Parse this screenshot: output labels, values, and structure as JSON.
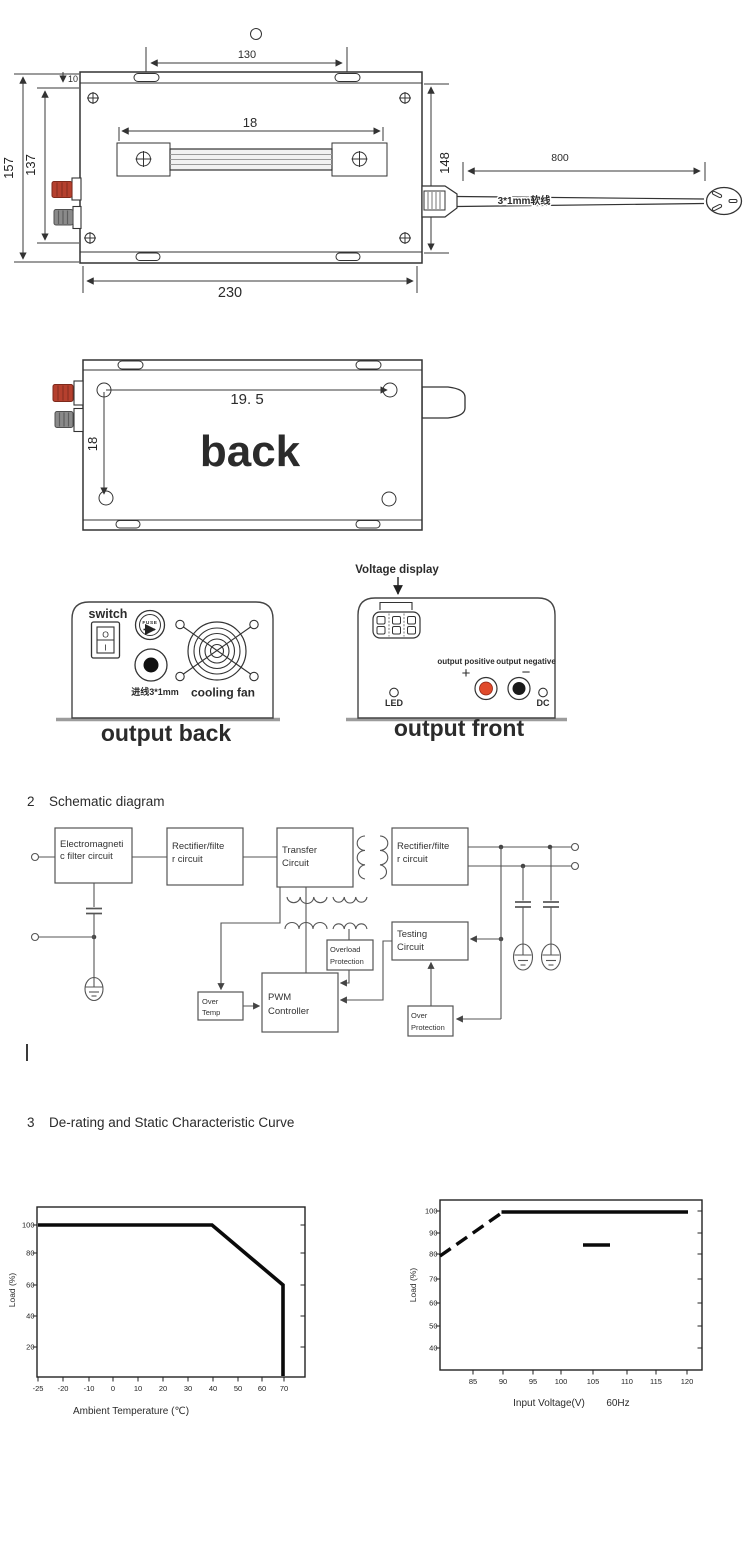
{
  "top_view": {
    "dim_130": "130",
    "dim_18": "18",
    "dim_148": "148",
    "dim_157": "157",
    "dim_137": "137",
    "dim_10": "10",
    "dim_230": "230",
    "dim_800": "800",
    "cable_label": "3*1mm软线"
  },
  "back_view": {
    "dim_19_5": "19. 5",
    "dim_18": "18",
    "label": "back"
  },
  "output_back": {
    "switch_label": "switch",
    "switch_on": "O",
    "switch_off": "I",
    "fuse_label": "FUSE",
    "inlet_label": "进线3*1mm",
    "fan_label": "cooling fan",
    "caption": "output back"
  },
  "output_front": {
    "voltage_display_label": "Voltage display",
    "positive_label": "output positive",
    "negative_label": "output negative",
    "plus": "+",
    "minus": "−",
    "led_label": "LED",
    "dc_label": "DC",
    "caption": "output front"
  },
  "sections": {
    "schematic_no": "2",
    "schematic_title": "Schematic diagram",
    "derating_no": "3",
    "derating_title": "De-rating and Static Characteristic Curve"
  },
  "schematic_blocks": {
    "emi_1": "Electromagneti",
    "emi_2": "c filter circuit",
    "rect1_1": "Rectifier/filte",
    "rect1_2": "r circuit",
    "transfer_1": "Transfer",
    "transfer_2": "Circuit",
    "rect2_1": "Rectifier/filte",
    "rect2_2": "r circuit",
    "testing_1": "Testing",
    "testing_2": "Circuit",
    "overload_1": "Overload",
    "overload_2": "Protection",
    "pwm_1": "PWM",
    "pwm_2": "Controller",
    "overtemp_1": "Over",
    "overtemp_2": "Temp",
    "overprot_1": "Over",
    "overprot_2": "Protection"
  },
  "chart_data": [
    {
      "type": "line",
      "xlabel": "Ambient Temperature (℃)",
      "ylabel": "Load (%)",
      "xticks": [
        "-25",
        "-20",
        "-10",
        "0",
        "10",
        "20",
        "30",
        "40",
        "50",
        "60",
        "70"
      ],
      "yticks": [
        "100",
        "80",
        "60",
        "40",
        "20"
      ],
      "xlim": [
        -25,
        75
      ],
      "ylim": [
        0,
        110
      ],
      "grid": false,
      "legend": "none",
      "series": [
        {
          "name": "derating-load-vs-temperature",
          "points": [
            [
              -25,
              100
            ],
            [
              40,
              100
            ],
            [
              70,
              60
            ],
            [
              70,
              0
            ]
          ]
        }
      ]
    },
    {
      "type": "line",
      "xlabel": "Input Voltage(V)",
      "xlabel_note": "60Hz",
      "ylabel": "Load (%)",
      "xticks": [
        "85",
        "90",
        "95",
        "100",
        "105",
        "110",
        "115",
        "120"
      ],
      "yticks": [
        "100",
        "90",
        "80",
        "70",
        "60",
        "50",
        "40"
      ],
      "xlim": [
        81,
        123
      ],
      "ylim": [
        35,
        105
      ],
      "grid": false,
      "legend": "none",
      "series": [
        {
          "name": "load-vs-voltage-rising",
          "style": "dashed",
          "points": [
            [
              81,
              80
            ],
            [
              90,
              100
            ]
          ]
        },
        {
          "name": "load-vs-voltage-flat",
          "style": "solid",
          "points": [
            [
              90,
              100
            ],
            [
              120,
              100
            ]
          ]
        },
        {
          "name": "isolated-segment",
          "style": "solid",
          "points": [
            [
              103,
              85
            ],
            [
              107,
              85
            ]
          ]
        }
      ]
    }
  ]
}
